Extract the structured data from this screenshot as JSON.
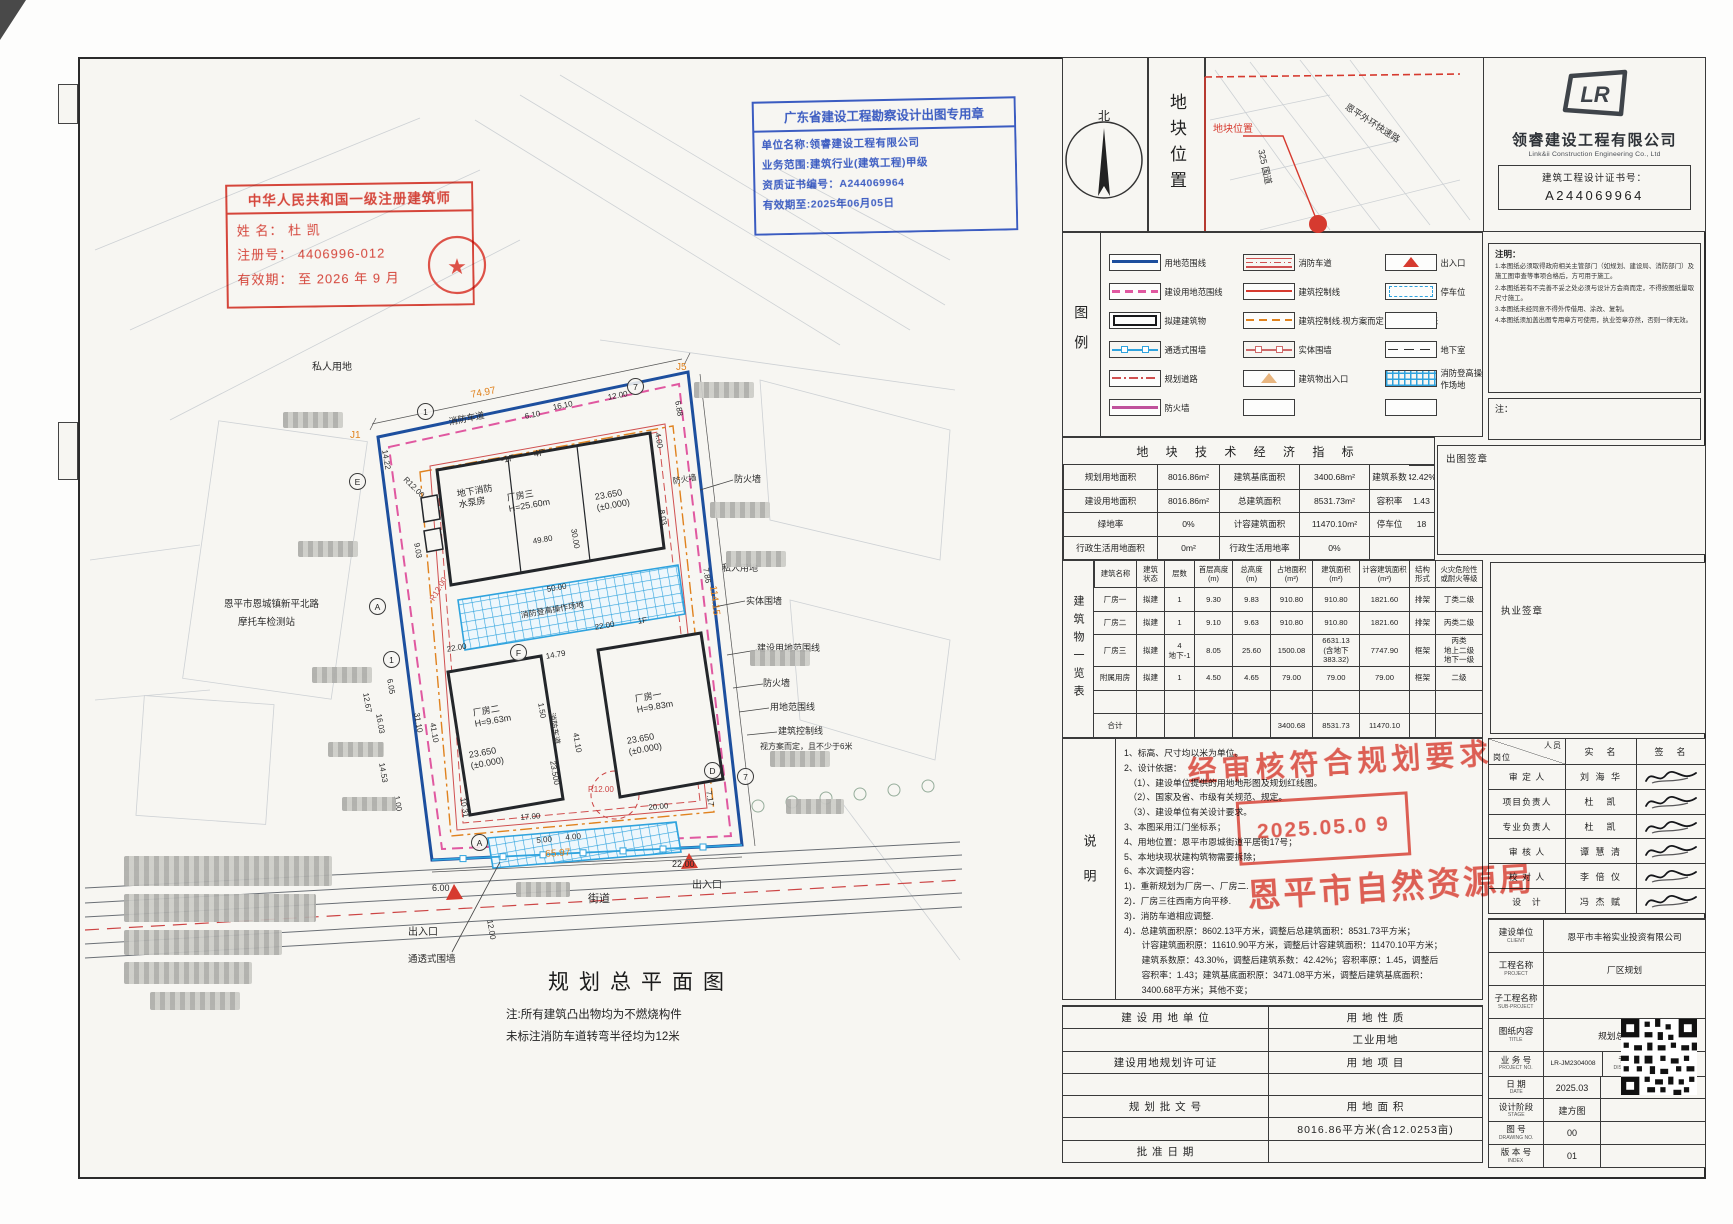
{
  "stamps": {
    "architect": {
      "title": "中华人民共和国一级注册建筑师",
      "name_row": "姓  名：    杜  凯",
      "reg_row": "注册号： 4406996-012",
      "valid_row": "有效期： 至 2026 年 9 月"
    },
    "blue": {
      "title": "广东省建设工程勘察设计出图专用章",
      "line1": "单位名称:领睿建设工程有限公司",
      "line2": "业务范围:建筑行业(建筑工程)甲级",
      "line3": "资质证书编号：A244069964",
      "line4": "有效期至:2025年06月05日"
    },
    "approval": {
      "line1": "经审核符合规划要求",
      "date": "2025.05.0 9",
      "agency": "恩平市自然资源局"
    }
  },
  "drawing": {
    "title": "规划总平面图",
    "notes": [
      "注:所有建筑凸出物均为不燃烧构件",
      "未标注消防车道转弯半径均为12米"
    ],
    "labels": [
      {
        "t": "私人用地",
        "x": 312,
        "y": 362,
        "s": 10
      },
      {
        "t": "J5",
        "x": 676,
        "y": 362,
        "s": 10,
        "c": "#e0821e"
      },
      {
        "t": "74.97",
        "x": 470,
        "y": 390,
        "s": 10,
        "c": "#e0821e",
        "r": -11
      },
      {
        "t": "消防车道",
        "x": 448,
        "y": 417,
        "s": 9,
        "r": -11
      },
      {
        "t": "J1",
        "x": 350,
        "y": 430,
        "s": 10,
        "c": "#e0821e"
      },
      {
        "t": "14.22",
        "x": 389,
        "y": 449,
        "s": 8,
        "r": 80
      },
      {
        "t": "16.10",
        "x": 552,
        "y": 403,
        "s": 8,
        "r": -11
      },
      {
        "t": "6.10",
        "x": 524,
        "y": 412,
        "s": 8,
        "r": -11
      },
      {
        "t": "12.00",
        "x": 607,
        "y": 393,
        "s": 8,
        "r": -11
      },
      {
        "t": "6.88",
        "x": 682,
        "y": 400,
        "s": 8,
        "r": 80
      },
      {
        "t": "4.00",
        "x": 662,
        "y": 432,
        "s": 8,
        "r": 80
      },
      {
        "t": "R12.00",
        "x": 408,
        "y": 475,
        "s": 8,
        "r": 45
      },
      {
        "t": "-1F",
        "x": 500,
        "y": 455,
        "s": 9,
        "r": -10
      },
      {
        "t": "4F",
        "x": 533,
        "y": 449,
        "s": 9,
        "r": -10
      },
      {
        "t": "地下消防\n水泵房",
        "x": 456,
        "y": 489,
        "s": 9,
        "r": -10
      },
      {
        "t": "厂房三\nH=25.60m",
        "x": 506,
        "y": 493,
        "s": 9,
        "r": -10
      },
      {
        "t": "23.650\n(±0.000)",
        "x": 594,
        "y": 492,
        "s": 9,
        "r": -10
      },
      {
        "t": "9.03",
        "x": 421,
        "y": 542,
        "s": 8,
        "r": 80
      },
      {
        "t": "30.00",
        "x": 578,
        "y": 528,
        "s": 8,
        "r": 80
      },
      {
        "t": "8.03",
        "x": 666,
        "y": 509,
        "s": 8,
        "r": 80
      },
      {
        "t": "49.80",
        "x": 532,
        "y": 537,
        "s": 8,
        "r": -10
      },
      {
        "t": "R12.00",
        "x": 428,
        "y": 598,
        "s": 8,
        "c": "#cc4444",
        "r": -60
      },
      {
        "t": "50.00",
        "x": 546,
        "y": 585,
        "s": 8,
        "r": -10
      },
      {
        "t": "消防登高操作场地",
        "x": 520,
        "y": 611,
        "s": 8,
        "r": -10
      },
      {
        "t": "7.86",
        "x": 710,
        "y": 567,
        "s": 8,
        "r": 80
      },
      {
        "t": "私人用地",
        "x": 722,
        "y": 563,
        "s": 9
      },
      {
        "t": "22.00",
        "x": 446,
        "y": 645,
        "s": 8,
        "r": -10
      },
      {
        "t": "14.79",
        "x": 545,
        "y": 652,
        "s": 8,
        "r": -10
      },
      {
        "t": "22.00",
        "x": 594,
        "y": 623,
        "s": 8,
        "r": -10
      },
      {
        "t": "1F",
        "x": 637,
        "y": 617,
        "s": 8,
        "r": -10
      },
      {
        "t": "12.67",
        "x": 370,
        "y": 692,
        "s": 8,
        "r": 80
      },
      {
        "t": "6.05",
        "x": 394,
        "y": 678,
        "s": 8,
        "r": 80
      },
      {
        "t": "16.03",
        "x": 383,
        "y": 713,
        "s": 8,
        "r": 80
      },
      {
        "t": "31.10",
        "x": 421,
        "y": 712,
        "s": 8,
        "r": 80
      },
      {
        "t": "41.10",
        "x": 437,
        "y": 722,
        "s": 8,
        "r": 80
      },
      {
        "t": "厂房二\nH=9.63m",
        "x": 472,
        "y": 708,
        "s": 9,
        "r": -10
      },
      {
        "t": "23.650\n(±0.000)",
        "x": 468,
        "y": 750,
        "s": 9,
        "r": -10
      },
      {
        "t": "1.50",
        "x": 545,
        "y": 702,
        "s": 8,
        "r": 80
      },
      {
        "t": "消防车道",
        "x": 556,
        "y": 712,
        "s": 8,
        "r": 80
      },
      {
        "t": "41.10",
        "x": 580,
        "y": 732,
        "s": 8,
        "r": 80
      },
      {
        "t": "厂房一\nH=9.83m",
        "x": 634,
        "y": 694,
        "s": 9,
        "r": -10
      },
      {
        "t": "23.650\n(±0.000)",
        "x": 626,
        "y": 736,
        "s": 9,
        "r": -10
      },
      {
        "t": "23.500",
        "x": 557,
        "y": 760,
        "s": 8,
        "r": 80
      },
      {
        "t": "14.53",
        "x": 386,
        "y": 762,
        "s": 8,
        "r": 80
      },
      {
        "t": "1.00",
        "x": 401,
        "y": 795,
        "s": 8,
        "r": 80
      },
      {
        "t": "10.31",
        "x": 467,
        "y": 797,
        "s": 8,
        "r": 80
      },
      {
        "t": "17.00",
        "x": 520,
        "y": 813,
        "s": 8,
        "r": -5
      },
      {
        "t": "R12.00",
        "x": 588,
        "y": 785,
        "s": 8,
        "c": "#cc4444"
      },
      {
        "t": "20.00",
        "x": 648,
        "y": 803,
        "s": 8,
        "r": -5
      },
      {
        "t": "7.17",
        "x": 713,
        "y": 790,
        "s": 8,
        "r": 80
      },
      {
        "t": "5.00",
        "x": 536,
        "y": 836,
        "s": 8,
        "r": -5
      },
      {
        "t": "4.00",
        "x": 565,
        "y": 833,
        "s": 8,
        "r": -5
      },
      {
        "t": "6.00",
        "x": 432,
        "y": 883,
        "s": 9
      },
      {
        "t": "22.00",
        "x": 672,
        "y": 859,
        "s": 9
      },
      {
        "t": "65.97",
        "x": 545,
        "y": 849,
        "s": 10,
        "c": "#e0821e",
        "r": -4
      },
      {
        "t": "114.15",
        "x": 718,
        "y": 585,
        "s": 10,
        "c": "#e0821e",
        "r": 83
      },
      {
        "t": "出入口",
        "x": 408,
        "y": 927,
        "s": 10
      },
      {
        "t": "出入口",
        "x": 692,
        "y": 880,
        "s": 10
      },
      {
        "t": "街道",
        "x": 588,
        "y": 893,
        "s": 11
      },
      {
        "t": "12.00",
        "x": 494,
        "y": 919,
        "s": 8,
        "r": 80
      },
      {
        "t": "通透式围墙",
        "x": 408,
        "y": 954,
        "s": 9.5
      },
      {
        "t": "防火墙",
        "x": 734,
        "y": 474,
        "s": 9
      },
      {
        "t": "实体围墙",
        "x": 746,
        "y": 596,
        "s": 9
      },
      {
        "t": "建设用地范围线",
        "x": 757,
        "y": 643,
        "s": 9
      },
      {
        "t": "防火墙",
        "x": 763,
        "y": 678,
        "s": 9
      },
      {
        "t": "用地范围线",
        "x": 770,
        "y": 702,
        "s": 9
      },
      {
        "t": "建筑控制线",
        "x": 778,
        "y": 726,
        "s": 9
      },
      {
        "t": "视方案而定，且不少于6米",
        "x": 760,
        "y": 742,
        "s": 8
      },
      {
        "t": "恩平市恩城镇新平北路",
        "x": 224,
        "y": 599,
        "s": 9.5
      },
      {
        "t": "摩托车检测站",
        "x": 238,
        "y": 617,
        "s": 9.5
      },
      {
        "t": "防火墙",
        "x": 672,
        "y": 477,
        "s": 8,
        "r": -10
      }
    ],
    "bubbles": [
      {
        "t": "1",
        "x": 417,
        "y": 403
      },
      {
        "t": "7",
        "x": 627,
        "y": 378
      },
      {
        "t": "E",
        "x": 349,
        "y": 473
      },
      {
        "t": "A",
        "x": 369,
        "y": 598
      },
      {
        "t": "1",
        "x": 383,
        "y": 651
      },
      {
        "t": "F",
        "x": 510,
        "y": 644
      },
      {
        "t": "D",
        "x": 704,
        "y": 762
      },
      {
        "t": "7",
        "x": 737,
        "y": 768
      },
      {
        "t": "A",
        "x": 471,
        "y": 834
      }
    ],
    "blurs": [
      {
        "x": 283,
        "y": 412,
        "w": 60,
        "h": 16
      },
      {
        "x": 298,
        "y": 541,
        "w": 60,
        "h": 16
      },
      {
        "x": 312,
        "y": 667,
        "w": 60,
        "h": 16
      },
      {
        "x": 328,
        "y": 742,
        "w": 56,
        "h": 15
      },
      {
        "x": 342,
        "y": 797,
        "w": 54,
        "h": 14
      },
      {
        "x": 694,
        "y": 382,
        "w": 60,
        "h": 16
      },
      {
        "x": 710,
        "y": 502,
        "w": 60,
        "h": 16
      },
      {
        "x": 726,
        "y": 551,
        "w": 60,
        "h": 16
      },
      {
        "x": 750,
        "y": 650,
        "w": 60,
        "h": 16
      },
      {
        "x": 770,
        "y": 751,
        "w": 60,
        "h": 16
      },
      {
        "x": 786,
        "y": 799,
        "w": 58,
        "h": 15
      },
      {
        "x": 516,
        "y": 882,
        "w": 54,
        "h": 15
      },
      {
        "x": 124,
        "y": 856,
        "w": 208,
        "h": 30
      },
      {
        "x": 124,
        "y": 894,
        "w": 192,
        "h": 28
      },
      {
        "x": 124,
        "y": 930,
        "w": 158,
        "h": 25
      },
      {
        "x": 124,
        "y": 962,
        "w": 128,
        "h": 22
      },
      {
        "x": 150,
        "y": 992,
        "w": 90,
        "h": 18
      }
    ]
  },
  "panel": {
    "north_label": "北",
    "location_title": "地块位置",
    "map": {
      "plot_label": "地块位置",
      "road1": "325 国道",
      "road2": "恩平外环快速路"
    },
    "company": {
      "name": "领睿建设工程有限公司",
      "name_en": "Link&ii Construction Engineering Co., Ltd",
      "cert_label": "建筑工程设计证书号：",
      "cert_no": "A244069964"
    },
    "notices": {
      "title": "注明：",
      "items": [
        "1.本图纸必须取得政府相关主管部门（如规划、建设局、消防部门）及施工图审查等事项合格后，方可用于施工。",
        "2.本图纸若有不完善不妥之处必须与设计方会商而定，不得按图纸量取尺寸施工。",
        "3.本图纸未经同意不得外传借用、涂改、复制。",
        "4.本图纸须加盖出图专用章方可使用，执业签章亦然，否则一律无效。"
      ]
    },
    "note_box_label": "注：",
    "chutu_label": "出图签章",
    "zhiye_label": "执业签章",
    "legend": {
      "title": "图例",
      "cells": [
        {
          "sym": "sym-blue-double",
          "label": "用地范围线"
        },
        {
          "sym": "sym-fire-lane",
          "label": "消防车道"
        },
        {
          "sym": "sym-tri-red",
          "label": "出入口"
        },
        {
          "sym": "sym-pink-dash",
          "label": "建设用地范围线"
        },
        {
          "sym": "sym-red-solid",
          "label": "建筑控制线"
        },
        {
          "sym": "sym-parking",
          "label": "停车位"
        },
        {
          "sym": "sym-black-rect",
          "label": "拟建建筑物"
        },
        {
          "sym": "sym-orange-dash",
          "label": "建筑控制线.视方案而定，且不少于6米"
        },
        {
          "label": ""
        },
        {
          "sym": "sym-blue-squares",
          "label": "通透式围墙"
        },
        {
          "sym": "sym-red-squares",
          "label": "实体围墙"
        },
        {
          "sym": "sym-dash",
          "label": "地下室"
        },
        {
          "sym": "sym-red-dashdot",
          "label": "规划道路"
        },
        {
          "sym": "sym-tri-tan",
          "label": "建筑物出入口"
        },
        {
          "sym": "sym-blue-grid",
          "label": "消防登高操\n作场地"
        },
        {
          "sym": "sym-magenta",
          "label": "防火墙"
        },
        {
          "label": ""
        },
        {
          "label": ""
        }
      ]
    },
    "indicators": {
      "title": "地 块 技 术 经 济 指 标",
      "cells": [
        "规划用地面积",
        "8016.86m²",
        "建筑基底面积",
        "3400.68m²",
        "建筑系数",
        "42.42%",
        "建设用地面积",
        "8016.86m²",
        "总建筑面积",
        "8531.73m²",
        "容积率",
        "1.43",
        "绿地率",
        "0%",
        "计容建筑面积",
        "11470.10m²",
        "停车位",
        "18",
        "行政生活用地面积",
        "0m²",
        "行政生活用地率",
        "0%",
        "",
        ""
      ]
    },
    "buildings": {
      "side_label": "建筑物一览表",
      "headers": [
        "建筑名称",
        "建筑\n状态",
        "层数",
        "首层高度\n(m)",
        "总高度\n(m)",
        "占地面积\n(m²)",
        "建筑面积\n(m²)",
        "计容建筑面积\n(m²)",
        "结构\n形式",
        "火灾危险性\n或耐火等级"
      ],
      "rows": [
        [
          "厂房一",
          "拟建",
          "1",
          "9.30",
          "9.83",
          "910.80",
          "910.80",
          "1821.60",
          "排架",
          "丁类二级"
        ],
        [
          "厂房二",
          "拟建",
          "1",
          "9.10",
          "9.63",
          "910.80",
          "910.80",
          "1821.60",
          "排架",
          "丙类二级"
        ],
        [
          "厂房三",
          "拟建",
          "4\n地下-1",
          "8.05",
          "25.60",
          "1500.08",
          "6631.13\n(含地下\n383.32)",
          "7747.90",
          "框架",
          "丙类\n地上二级\n地下一级"
        ],
        [
          "附属用房",
          "拟建",
          "1",
          "4.50",
          "4.65",
          "79.00",
          "79.00",
          "79.00",
          "框架",
          "二级"
        ],
        [
          "",
          "",
          "",
          "",
          "",
          "",
          "",
          "",
          "",
          ""
        ],
        [
          "合计",
          "",
          "",
          "",
          "",
          "3400.68",
          "8531.73",
          "11470.10",
          "",
          ""
        ]
      ]
    },
    "shuoming": {
      "side_label": "说明",
      "lines": [
        "1、标高、尺寸均以米为单位。",
        "2、设计依据：",
        "　（1）、建设单位提供的用地地形图及规划红线图。",
        "　（2）、国家及省、市级有关规范、规定。",
        "　（3）、建设单位有关设计要求。",
        "3、本图采用江门坐标系；",
        "4、用地位置：恩平市恩城街道平居街17号；",
        "5、本地块现状建构筑物需要拆除；",
        "6、本次调整内容：",
        "1)．重新规划为厂房一、厂房二.",
        "2)．厂房三往西南方向平移.",
        "3)．消防车道相应调整.",
        "4)．总建筑面积原：8602.13平方米，调整后总建筑面积：8531.73平方米；",
        "　　计容建筑面积原：11610.90平方米，调整后计容建筑面积：11470.10平方米；",
        "　　建筑系数原：43.30%，调整后建筑系数：42.42%；容积率原：1.45，调整后",
        "　　容积率：1.43；建筑基底面积原：3471.08平方米，调整后建筑基底面积：",
        "　　3400.68平方米；其他不变；"
      ]
    },
    "landuse": {
      "rows": [
        {
          "l": "建 设 用 地 单 位",
          "r": "用 地 性 质"
        },
        {
          "l": "",
          "r": "工业用地"
        },
        {
          "l": "建设用地规划许可证",
          "r": "用 地 项 目"
        },
        {
          "l": "",
          "r": ""
        },
        {
          "l": "规 划 批 文 号",
          "r": "用 地 面 积"
        },
        {
          "l": "",
          "r": "8016.86平方米(合12.0253亩)"
        },
        {
          "l": "批 准 日 期",
          "r": ""
        }
      ]
    },
    "signoff": {
      "corner_role": "岗位",
      "corner_person": "人员",
      "col_real": "实　名",
      "col_sign": "签　名",
      "rows": [
        {
          "role": "审 定 人",
          "name": "刘 海 华"
        },
        {
          "role": "项目负责人",
          "name": "杜　凯"
        },
        {
          "role": "专业负责人",
          "name": "杜　凯"
        },
        {
          "role": "审 核 人",
          "name": "谭 慧 清"
        },
        {
          "role": "校 对 人",
          "name": "李 倍 仪"
        },
        {
          "role": "设　计",
          "name": "冯 杰 赋"
        }
      ]
    },
    "titleblock": {
      "rows": [
        {
          "label": "建设单位",
          "sub": "CLIENT",
          "value": "恩平市丰裕实业投资有限公司"
        },
        {
          "label": "工程名称",
          "sub": "PROJECT",
          "value": "厂区规划"
        },
        {
          "label": "子工程名称",
          "sub": "SUB-PROJECT",
          "value": ""
        },
        {
          "label": "图纸内容",
          "sub": "TITLE",
          "value": "规划总平面图"
        }
      ],
      "biz_label": "业 务 号",
      "biz_sub": "PROJECT NO.",
      "biz_no": "LR-JM2304008",
      "disc_label": "专  业",
      "disc_sub": "DISCIPLINE",
      "discipline": "建  筑",
      "date_label": "日  期",
      "date_sub": "DATE",
      "date": "2025.03",
      "qr_label": "归 档 二 维 码：",
      "stage_label": "设计阶段",
      "stage_sub": "STAGE",
      "stage": "建方图",
      "dno_label": "图  号",
      "dno_sub": "DRAWING NO.",
      "drawing_no": "00",
      "idx_label": "版 本 号",
      "idx_sub": "INDEX",
      "index": "01"
    }
  }
}
